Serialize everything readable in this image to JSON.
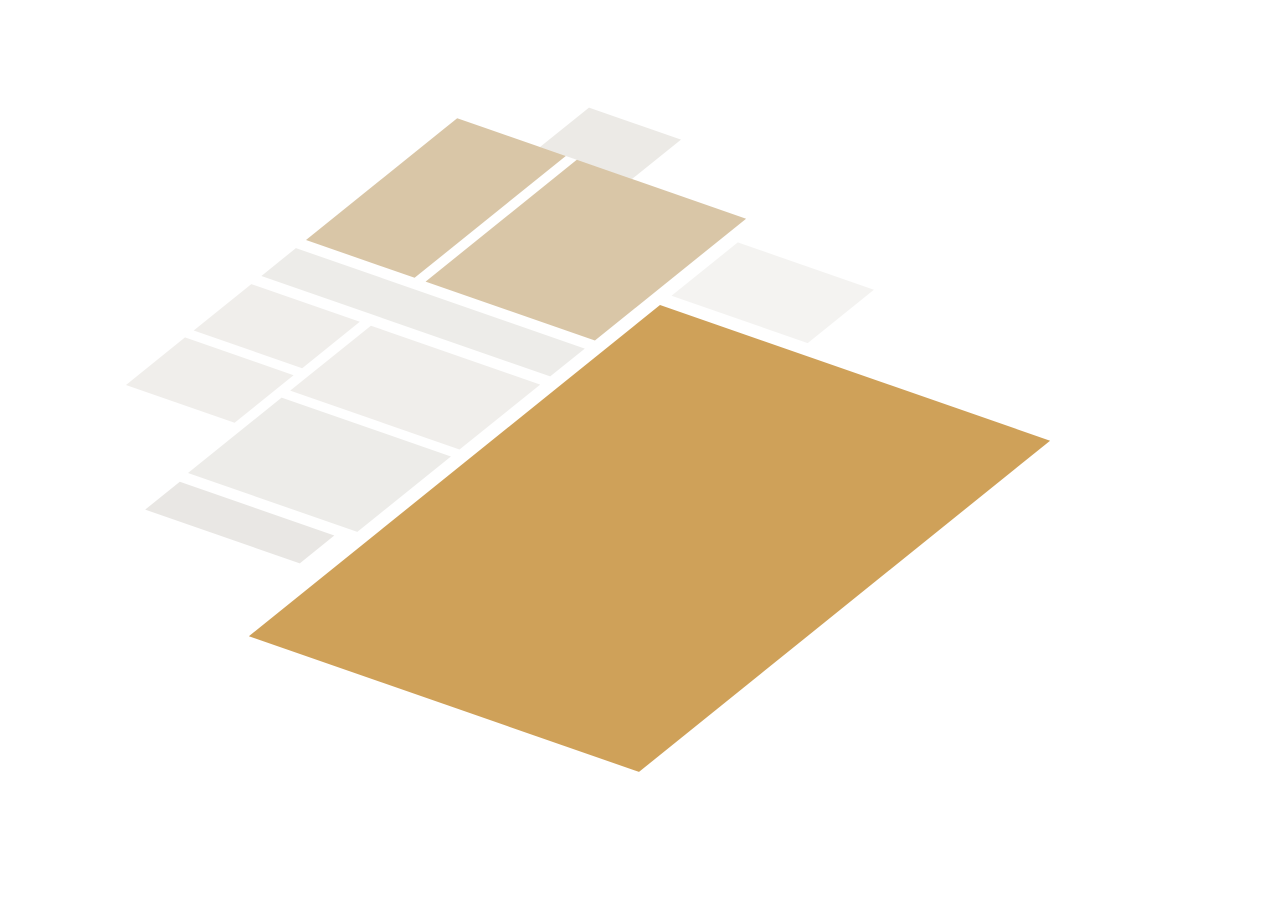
{
  "meta": {
    "kind": "3d-floorplan-render",
    "background": "#FFFFFF",
    "canvas": {
      "w": 1272,
      "h": 900
    }
  },
  "projection": {
    "e1": [
      0.92,
      0.32
    ],
    "e2": [
      -0.72,
      0.58
    ],
    "origin": [
      660,
      305
    ],
    "wallHeight": 86
  },
  "palette": {
    "wallTop": "#383C40",
    "wallFaceEast": "#F7F7F6",
    "wallFaceSouth": "#E0E0DF",
    "wallFaceWest": "#C7C7C6",
    "floorLiving": "#CFA159",
    "floorBedroom": "#D9C6A7",
    "floorPale": "#F0EEEB",
    "glassPane": "#F2EADA",
    "windowFrame": "#FFFFFF",
    "openingFloor": "#C89B55",
    "pipeRed": "#B5492B",
    "pipeDark": "#2E3134",
    "steelSink": "#D4D7D9",
    "burner": "#36393B"
  },
  "styles": {
    "wall": {
      "t": "#383C40",
      "e": "#F7F7F6",
      "s": "#E0E0DF",
      "ts": "#2A2E31"
    },
    "wallW": {
      "t": "#383C40",
      "e": "#F7F7F6",
      "s": "#E0E0DF",
      "w": "#C7C7C6",
      "ts": "#2A2E31"
    },
    "dark": {
      "t": "#33373B",
      "e": "#4A4E52",
      "s": "#26292C",
      "ts": "#202326"
    },
    "furn": {
      "t": "#FBFBFA",
      "e": "#F1F1F0",
      "s": "#E3E3E2",
      "stroke": "#D2D2D1"
    },
    "colGray": {
      "t": "#33373B",
      "e": "#D7DADC",
      "s": "#F4F4F3",
      "ts": "#202326"
    },
    "leaf": {
      "t": "#FAFAF9",
      "e": "#F0F0EF",
      "s": "#F6F6F5",
      "stroke": "#C6C6C5"
    }
  },
  "glass": {
    "pane": "#F2EADA",
    "frame": "#FFFFFF",
    "opacity": 0.93
  },
  "facade": {
    "floor": "#C89B55",
    "band": "#F3F3F2",
    "frame": "#FFFFFF"
  },
  "railing": {
    "baluster": "#D2D2D1",
    "rail": "#FBFBFA",
    "railStroke": "#D8D8D7"
  },
  "floors": [
    {
      "n": "top-room-floor",
      "b": [
        -240,
        -208,
        -140,
        -140
      ],
      "c": "#ECEAE6"
    },
    {
      "n": "bedroom-2-floor",
      "b": [
        -330,
        -140,
        -212,
        70
      ],
      "c": "#D9C6A7"
    },
    {
      "n": "bedroom-1-floor",
      "b": [
        -200,
        -140,
        -16,
        70
      ],
      "c": "#D9C6A7"
    },
    {
      "n": "stairwell-floor",
      "b": [
        0,
        -108,
        148,
        -16
      ],
      "c": "#F4F3F1"
    },
    {
      "n": "hallway-floor",
      "b": [
        -330,
        84,
        -16,
        132
      ],
      "c": "#EDECE9"
    },
    {
      "n": "storage-1-floor",
      "b": [
        -330,
        146,
        -212,
        226
      ],
      "c": "#F0EEEB"
    },
    {
      "n": "storage-2-floor",
      "b": [
        -330,
        238,
        -212,
        320
      ],
      "c": "#F0EEEB"
    },
    {
      "n": "bathroom-floor",
      "b": [
        -200,
        146,
        -16,
        258
      ],
      "c": "#F0EEEB"
    },
    {
      "n": "entry-hall-floor",
      "b": [
        -200,
        270,
        -16,
        400
      ],
      "c": "#EDECE9"
    },
    {
      "n": "porch-floor",
      "b": [
        -198,
        414,
        -30,
        462
      ],
      "c": "#E9E7E4"
    },
    {
      "n": "living-room-floor",
      "b": [
        0,
        0,
        424,
        571
      ],
      "c": "#CFA159"
    }
  ],
  "items": [
    {
      "n": "top-room-wall-nw-left",
      "t": "box",
      "b": [
        -252,
        -220,
        -226,
        -208
      ]
    },
    {
      "n": "top-room-window",
      "t": "glass",
      "b": [
        -226,
        -220,
        -166,
        -208
      ],
      "sill": 20,
      "mull": 1
    },
    {
      "n": "top-room-wall-nw-right",
      "t": "box",
      "b": [
        -166,
        -220,
        -128,
        -208
      ]
    },
    {
      "n": "top-room-wall-west",
      "t": "box",
      "b": [
        -252,
        -208,
        -240,
        -140
      ],
      "st": "wallW"
    },
    {
      "n": "top-room-wall-east",
      "t": "box",
      "b": [
        -140,
        -208,
        -128,
        -140
      ]
    },
    {
      "n": "chimney-block",
      "t": "box",
      "b": [
        -212,
        -162,
        -182,
        -140
      ],
      "h": 90,
      "st": "dark",
      "pr": 2
    },
    {
      "n": "bedrooms-ne-wall-1",
      "t": "box",
      "b": [
        -342,
        -156,
        -310,
        -140
      ]
    },
    {
      "n": "bedroom-2-window",
      "t": "glass",
      "b": [
        -310,
        -156,
        -240,
        -140
      ],
      "sill": 16,
      "mull": 1
    },
    {
      "n": "bedrooms-ne-wall-2",
      "t": "box",
      "b": [
        -240,
        -156,
        -180,
        -140
      ]
    },
    {
      "n": "bedroom-1-window",
      "t": "glass",
      "b": [
        -180,
        -156,
        -90,
        -140
      ],
      "sill": 16,
      "mull": 1
    },
    {
      "n": "bedrooms-ne-wall-3",
      "t": "box",
      "b": [
        -90,
        -156,
        -16,
        -140
      ]
    },
    {
      "n": "west-facade-wall",
      "t": "box",
      "b": [
        -342,
        -140,
        -330,
        334
      ],
      "st": "wallW"
    },
    {
      "n": "bedroom-separator-wall",
      "t": "box",
      "b": [
        -212,
        -140,
        -200,
        70
      ]
    },
    {
      "n": "bedroom-1-east-wall-a",
      "t": "box",
      "b": [
        -16,
        -140,
        0,
        8
      ]
    },
    {
      "n": "bedroom-1-door",
      "t": "box",
      "b": [
        -14,
        10,
        -3,
        52
      ],
      "h": 74,
      "st": "leaf",
      "pr": 2
    },
    {
      "n": "bedroom-1-east-wall-b",
      "t": "box",
      "b": [
        -16,
        52,
        0,
        84
      ]
    },
    {
      "n": "bedrooms-south-wall-1",
      "t": "box",
      "b": [
        -330,
        70,
        -290,
        84
      ]
    },
    {
      "n": "bedroom-2-door",
      "t": "box",
      "b": [
        -288,
        72,
        -254,
        83
      ],
      "h": 74,
      "st": "leaf",
      "pr": 2
    },
    {
      "n": "bedrooms-south-wall-2",
      "t": "box",
      "b": [
        -252,
        70,
        -122,
        84
      ]
    },
    {
      "n": "bedroom-1-south-door",
      "t": "box",
      "b": [
        -120,
        72,
        -86,
        83
      ],
      "h": 74,
      "st": "leaf",
      "pr": 2
    },
    {
      "n": "bedrooms-south-wall-3",
      "t": "box",
      "b": [
        -84,
        70,
        0,
        84
      ]
    },
    {
      "n": "hallway-south-wall-1",
      "t": "box",
      "b": [
        -330,
        132,
        -300,
        146
      ]
    },
    {
      "n": "storage-door",
      "t": "box",
      "b": [
        -298,
        133,
        -264,
        145
      ],
      "h": 74,
      "st": "leaf",
      "pr": 2
    },
    {
      "n": "hallway-south-wall-2",
      "t": "box",
      "b": [
        -262,
        132,
        -182,
        146
      ]
    },
    {
      "n": "bathroom-door",
      "t": "box",
      "b": [
        -180,
        133,
        -146,
        145
      ],
      "h": 74,
      "st": "leaf",
      "pr": 2
    },
    {
      "n": "hallway-south-wall-3",
      "t": "box",
      "b": [
        -144,
        132,
        0,
        146
      ]
    },
    {
      "n": "storage-divider-wall",
      "t": "box",
      "b": [
        -330,
        226,
        -212,
        238
      ]
    },
    {
      "n": "storage-east-wall",
      "t": "box",
      "b": [
        -212,
        146,
        -200,
        414
      ]
    },
    {
      "n": "bathroom-entry-wall-a",
      "t": "box",
      "b": [
        -200,
        258,
        -140,
        270
      ]
    },
    {
      "n": "bathroom-entry-wall-b",
      "t": "box",
      "b": [
        -95,
        258,
        -16,
        270
      ]
    },
    {
      "n": "living-nw-wall",
      "t": "box",
      "b": [
        -16,
        132,
        0,
        571
      ]
    },
    {
      "n": "storage-south-wall",
      "t": "box",
      "b": [
        -342,
        320,
        -200,
        334
      ]
    },
    {
      "n": "entry-south-wall-a",
      "t": "box",
      "b": [
        -212,
        400,
        -130,
        414
      ]
    },
    {
      "n": "entry-door",
      "t": "box",
      "b": [
        -128,
        401,
        -82,
        413
      ],
      "h": 74,
      "st": "leaf",
      "pr": 2
    },
    {
      "n": "entry-south-wall-b",
      "t": "box",
      "b": [
        -80,
        400,
        -16,
        414
      ]
    },
    {
      "n": "porch-west-wall",
      "t": "box",
      "b": [
        -212,
        414,
        -198,
        470
      ],
      "z1": -30,
      "st": "wallW"
    },
    {
      "n": "porch-east-wall",
      "t": "box",
      "b": [
        -30,
        414,
        -16,
        470
      ],
      "z1": -30
    },
    {
      "n": "stairwell-north-wall",
      "t": "box",
      "b": [
        -16,
        -122,
        156,
        -108
      ]
    },
    {
      "n": "stair-steps",
      "t": "steps",
      "xs": [
        40,
        64,
        88,
        112
      ],
      "y1": -100,
      "y2": -26,
      "c": "#DCD9D5",
      "d": -120
    },
    {
      "n": "stair-railing-run-1",
      "t": "rail",
      "p1": [
        16,
        -98
      ],
      "p2": [
        142,
        -98
      ],
      "count": 10,
      "h": 50,
      "d": -90
    },
    {
      "n": "stair-railing-run-2",
      "t": "rail",
      "p1": [
        142,
        -98
      ],
      "p2": [
        142,
        -26
      ],
      "count": 7,
      "h": 50,
      "d": -85
    },
    {
      "n": "living-ne-glass-doors",
      "t": "glass",
      "b": [
        0,
        -16,
        108,
        0
      ],
      "sill": 4,
      "mull": 3
    },
    {
      "n": "ne-chimney",
      "t": "box",
      "b": [
        108,
        -56,
        148,
        0
      ],
      "pr": 2
    },
    {
      "n": "ne-pier-1",
      "t": "box",
      "b": [
        148,
        -16,
        190,
        0
      ]
    },
    {
      "n": "living-ne-window-1",
      "t": "glass",
      "b": [
        190,
        -16,
        318,
        0
      ],
      "sill": 14,
      "mull": 2
    },
    {
      "n": "ne-pier-2",
      "t": "box",
      "b": [
        318,
        -16,
        354,
        0
      ]
    },
    {
      "n": "ne-pillar",
      "t": "box",
      "b": [
        318,
        0,
        354,
        36
      ],
      "st": "colGray",
      "pr": 2
    },
    {
      "n": "living-ne-window-2",
      "t": "glass",
      "b": [
        354,
        -16,
        424,
        0
      ],
      "sill": 14,
      "mull": 1
    },
    {
      "n": "ne-corner-post",
      "t": "box",
      "b": [
        424,
        -16,
        440,
        0
      ]
    },
    {
      "n": "column",
      "t": "box",
      "b": [
        296,
        236,
        332,
        270
      ],
      "st": "colGray"
    },
    {
      "n": "kitchen-counter",
      "t": "box",
      "b": [
        0,
        160,
        58,
        380
      ],
      "h": 46,
      "st": "furn"
    },
    {
      "n": "kitchen-cabinet",
      "t": "box",
      "b": [
        0,
        380,
        62,
        440
      ],
      "h": 84,
      "st": "furn"
    },
    {
      "n": "toilet-cistern",
      "t": "box",
      "b": [
        -196,
        156,
        -188,
        182
      ],
      "h": 34,
      "st": "furn"
    },
    {
      "n": "toilet",
      "t": "toilet",
      "b": [
        -188,
        160,
        -168,
        178
      ],
      "h": 16,
      "cx": -176,
      "cy": 169
    },
    {
      "n": "washbasin",
      "t": "box",
      "b": [
        -196,
        200,
        -174,
        222
      ],
      "h": 30,
      "st": "furn"
    },
    {
      "n": "se-facade-wall",
      "t": "facade",
      "b": [
        424,
        0,
        440,
        587
      ],
      "z1": -55,
      "pr": 3,
      "openings": [
        {
          "y": [
            60,
            205
          ],
          "z": [
            -18,
            68
          ]
        },
        {
          "y": [
            275,
            465
          ],
          "z": [
            -18,
            68
          ]
        }
      ]
    },
    {
      "n": "sw-facade-wall-a",
      "t": "box",
      "b": [
        -16,
        571,
        260,
        587
      ],
      "z1": -55,
      "pr": 2
    },
    {
      "n": "sw-door-threshold",
      "t": "box",
      "b": [
        260,
        571,
        300,
        587
      ],
      "h": 6,
      "st": "dark",
      "pr": 2
    },
    {
      "n": "sw-facade-wall-b",
      "t": "box",
      "b": [
        300,
        571,
        440,
        587
      ],
      "z1": -55,
      "pr": 2
    },
    {
      "n": "utility-pipes",
      "t": "pipes",
      "z1": 40,
      "z2": 140,
      "pr": 1000,
      "pts": [
        [
          5,
          134,
          "#B5492B"
        ],
        [
          5,
          141,
          "#B5492B"
        ],
        [
          5,
          149,
          "#2E3134"
        ],
        [
          5,
          156,
          "#2E3134"
        ],
        [
          5,
          163,
          "#2E3134"
        ]
      ]
    },
    {
      "n": "stove",
      "t": "stove",
      "b": [
        8,
        188,
        52,
        236
      ],
      "z": 46,
      "pr": 1000,
      "burners": [
        [
          20,
          201
        ],
        [
          40,
          201
        ],
        [
          20,
          223
        ],
        [
          40,
          223
        ]
      ]
    },
    {
      "n": "sink",
      "t": "sink",
      "b": [
        10,
        288,
        48,
        330
      ],
      "inner": [
        16,
        294,
        42,
        324
      ],
      "z": 46,
      "faucet": [
        29,
        291
      ],
      "pr": 1000
    }
  ]
}
